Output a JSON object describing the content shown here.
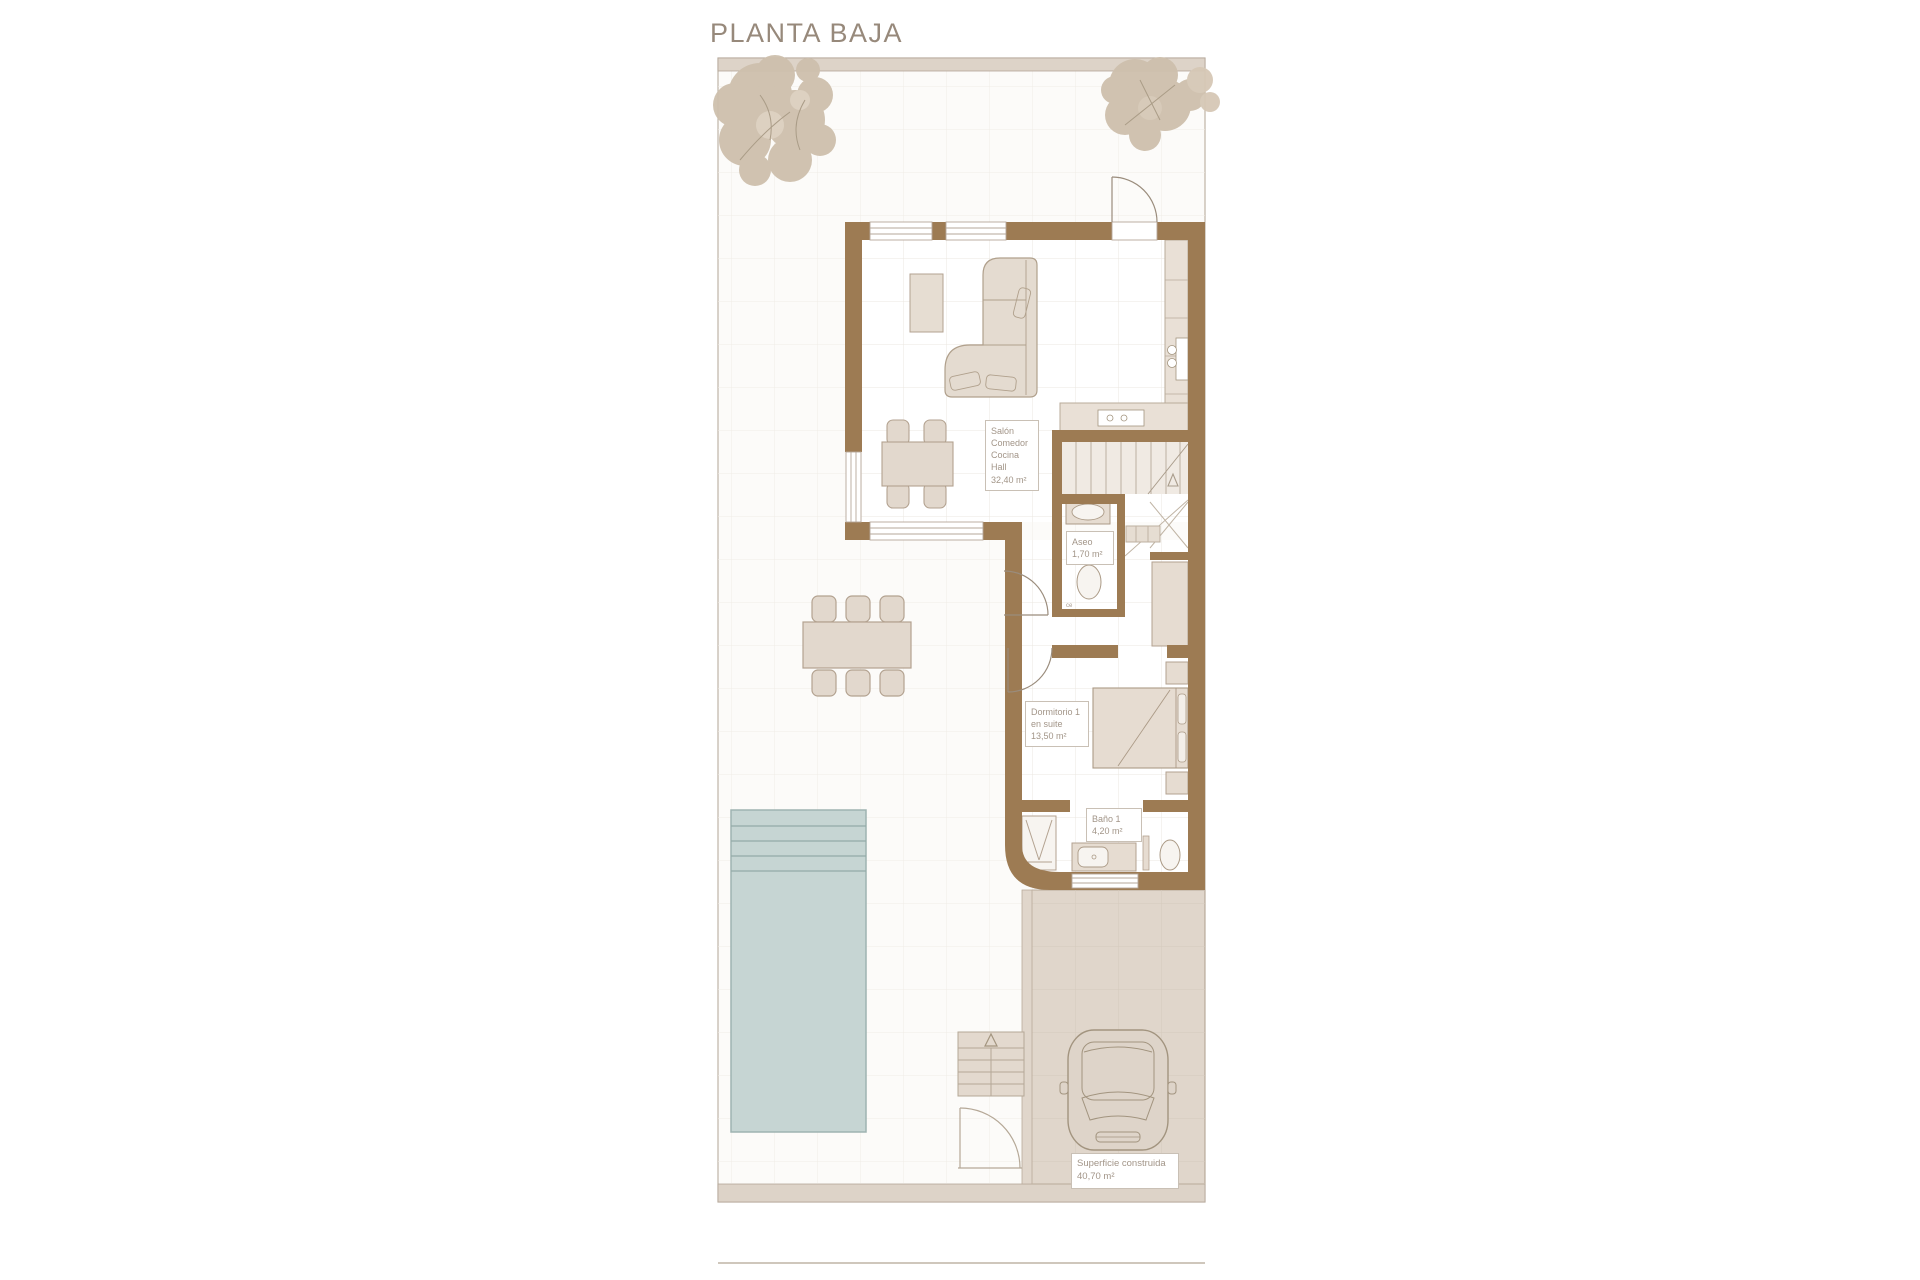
{
  "title": "PLANTA BAJA",
  "labels": {
    "living": {
      "lines": [
        "Salón",
        "Comedor",
        "Cocina",
        "Hall",
        "32,40 m²"
      ]
    },
    "aseo": {
      "lines": [
        "Aseo",
        "1,70 m²"
      ]
    },
    "dormitorio": {
      "lines": [
        "Dormitorio 1",
        "en suite",
        "13,50 m²"
      ]
    },
    "bano": {
      "lines": [
        "Baño 1",
        "4,20 m²"
      ]
    },
    "superficie": {
      "lines": [
        "Superficie construida",
        "40,70 m²"
      ]
    },
    "ce_mark": "ce"
  },
  "colors": {
    "wall": "#9d7b53",
    "pool": "#c6d5d3",
    "paving": "#ddd3c8",
    "tree": "#cec0ad",
    "label_text": "#a29588",
    "title_text": "#97897b"
  }
}
